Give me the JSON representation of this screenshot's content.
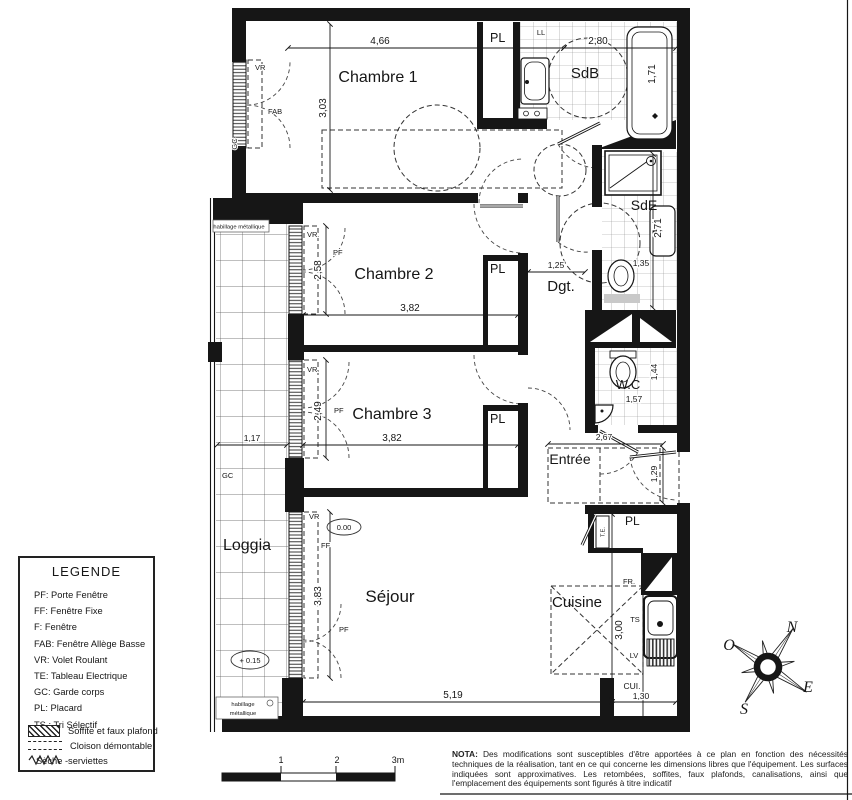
{
  "plan": {
    "rooms": {
      "chambre1": {
        "name": "Chambre 1",
        "width": "4,66",
        "height": "3,03"
      },
      "chambre2": {
        "name": "Chambre 2",
        "width": "3,82",
        "height": "2,58"
      },
      "chambre3": {
        "name": "Chambre 3",
        "width": "3,82",
        "height": "2,49"
      },
      "sdb": {
        "name": "SdB",
        "width": "2,80",
        "height": "1,71"
      },
      "sde": {
        "name": "SdE",
        "height": "2,71",
        "sink": "1,35"
      },
      "dgt": {
        "name": "Dgt.",
        "width": "1,25"
      },
      "wc": {
        "name": "W.C",
        "width": "1,57",
        "height": "1,44"
      },
      "entree": {
        "name": "Entrée",
        "width": "2,67",
        "door": "1,29"
      },
      "loggia": {
        "name": "Loggia",
        "width": "1,17"
      },
      "sejour": {
        "name": "Séjour",
        "width": "5,19",
        "height": "3,83"
      },
      "cuisine": {
        "name": "Cuisine",
        "height": "3,00",
        "width": "1,30",
        "abbr": "CUI."
      }
    },
    "tags": {
      "pl": "PL",
      "ll": "LL",
      "fab": "FAB",
      "vr": "VR",
      "pf": "PF",
      "ff": "FF",
      "gc": "GC",
      "te": "T.E.",
      "fr": "FR.",
      "ts": "TS",
      "lv": "LV"
    },
    "levels": {
      "sejour": "0.00",
      "loggia": "+ 0.15"
    },
    "cladding": "habillage métallique",
    "cladding_line1": "habillage",
    "cladding_line2": "métallique"
  },
  "legend": {
    "title": "LEGENDE",
    "items": [
      "PF: Porte Fenêtre",
      "FF: Fenêtre Fixe",
      "F: Fenêtre",
      "FAB: Fenêtre Allège Basse",
      "VR: Volet Roulant",
      "TE: Tableau Electrique",
      "GC: Garde corps",
      "PL: Placard",
      "TS : Tri Sélectif"
    ],
    "swatches": [
      {
        "label": "Soffite et faux plafond"
      },
      {
        "label": "Cloison démontable"
      },
      {
        "label": "Sèche -serviettes"
      }
    ]
  },
  "compass": {
    "north": "N",
    "west": "O",
    "east": "E",
    "south": "S"
  },
  "scalebar": {
    "tick1": "1",
    "tick2": "2",
    "tick3": "3m"
  },
  "nota": {
    "title": "NOTA:",
    "body": "Des modifications sont susceptibles d'être apportées à ce plan en fonction des nécessités techniques de la réalisation, tant en ce qui concerne les dimensions libres que l'équipement. Les surfaces indiquées sont approximatives. Les retombées, soffites, faux plafonds, canalisations, ainsi que l'emplacement des équipements sont figurés à titre indicatif"
  }
}
